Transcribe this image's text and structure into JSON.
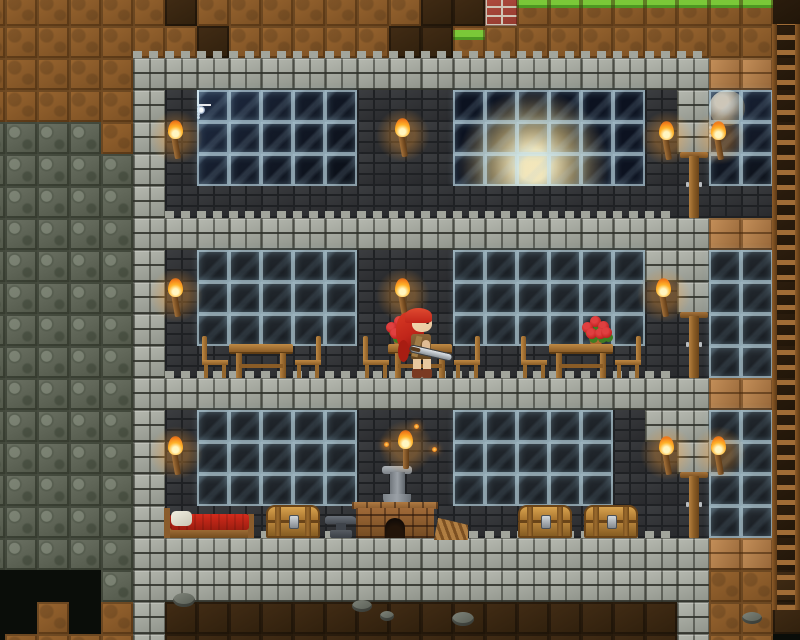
{
  "scene": {
    "name": "sandbox-building-scene",
    "description": "side-view 2d sandbox game: three-storey stone-brick house in a dirt hillside, night sky and earth visible through upper windows, dining room with red-haired character holding a sword, basement with bed, chests, anvil and furnace, ladder shaft on the right",
    "tile_size": 32,
    "origin": {
      "x": -27,
      "y": -6
    },
    "cols": 26,
    "rows": 21,
    "legend": {
      "D": "dirt-block",
      "G": "grass-block",
      "d": "dirt-wall-background",
      "K": "cave-darkness",
      "R": "red-brick-block",
      "s": "raw-stone-block",
      "S": "stone-brick-block",
      "B": "brick-wall-background",
      "W": "glass-window-block",
      "N": "glass-window-night-block",
      "E": "glass-window-earth-block",
      "P": "wood-plank-block",
      "L": "ladder-shaft-background"
    },
    "tilemap": [
      "DDDDDDdDDDDDDDddRGGGGGGGGL",
      "DDDDDDDdDDDDDddGDDDDDDDDDL",
      "DDDDDSSSSSSSSSSSSSSSSSSPPL",
      "DDDDDSBNNNNNBBBEEEEEEBSNNL",
      "ssssDSBNNNNNBBBEEEEEEBSNNL",
      "sssssSBNNNNNBBBEEEEEEBBNNL",
      "sssssSBBBBBBBBBBBBBBBBBBBL",
      "sssssSSSSSSSSSSSSSSSSSSPPL",
      "sssssSBWWWWWBBBWWWWWWSSWWL",
      "sssssSBWWWWWBBBWWWWWWBSWWL",
      "sssssSBWWWWWBBBWWWWWWBBWWL",
      "sssssSBBBBBBBBBBBBBBBBBWWL",
      "sssssSSSSSSSSSSSSSSSSSSPPL",
      "sssssSBWWWWWBBBWWWWWBSSWWL",
      "sssssSBWWWWWBBBWWWWWBBSWWL",
      "sssssSBWWWWWBBBWWWWWBBBWWL",
      "sssssSBBBBBBBBBBBBBBBBBWWL",
      "sssssSSSSSSSSSSSSSSSSSSPPL",
      "KKKKsSSSSSSSSSSSSSSSSSSDDd",
      "KKDKDSddddddddddddddddSDDd",
      "KDDDDSddddddddddddddddSDDK"
    ],
    "palette": {
      "stone": "#8f938a",
      "mortar": "#1f2124",
      "dirt": "#9a6630",
      "grass": "#74c534",
      "rawstone": "#6c7264",
      "glass": "#14181d",
      "glass_frame": "#cfe9f2",
      "wood": "#b5823e",
      "wood_dark": "#6a4418",
      "flame": "#ffb32a",
      "redbrick": "#b24e40",
      "blanket": "#d42b1c",
      "rose": "#c42222",
      "earth": "#4a80b8",
      "space": "#0c1220",
      "skin": "#e8c8a0",
      "hair": "#c0251a"
    },
    "backdrops": [
      {
        "t": "space-night",
        "x": 197,
        "y": 90,
        "w": 160,
        "h": 96,
        "children": [
          {
            "t": "star-big",
            "x": 24,
            "y": 12
          },
          {
            "t": "star-dot",
            "x": 12,
            "y": 4
          },
          {
            "t": "star-dot",
            "x": 58,
            "y": 24
          },
          {
            "t": "star-dot",
            "x": 104,
            "y": 18
          },
          {
            "t": "star-dot",
            "x": 132,
            "y": 62
          },
          {
            "t": "star-dot",
            "x": 84,
            "y": 46
          }
        ]
      },
      {
        "t": "space-earth",
        "x": 453,
        "y": 90,
        "w": 192,
        "h": 96,
        "children": []
      },
      {
        "t": "space-moon",
        "x": 709,
        "y": 90,
        "w": 64,
        "h": 96,
        "children": [
          {
            "t": "moon",
            "x": 3,
            "y": 62
          },
          {
            "t": "star-dot",
            "x": 12,
            "y": 8
          },
          {
            "t": "spark",
            "x": 22,
            "y": 12
          },
          {
            "t": "star-dot",
            "x": 44,
            "y": 36
          }
        ]
      }
    ],
    "entities": [
      {
        "t": "ledge",
        "x": 133,
        "y": 51,
        "w": 576
      },
      {
        "t": "ledge",
        "x": 165,
        "y": 211,
        "w": 512
      },
      {
        "t": "ledge",
        "x": 165,
        "y": 371,
        "w": 512
      },
      {
        "t": "ledge",
        "x": 165,
        "y": 531,
        "w": 512
      },
      {
        "t": "rose-pot",
        "x": 385,
        "y": 314
      },
      {
        "t": "rose-pot",
        "x": 581,
        "y": 314
      },
      {
        "t": "table",
        "x": 229,
        "y": 344
      },
      {
        "t": "table",
        "x": 388,
        "y": 344
      },
      {
        "t": "table",
        "x": 549,
        "y": 344
      },
      {
        "t": "chair",
        "x": 202,
        "y": 336,
        "dir": "right"
      },
      {
        "t": "chair",
        "x": 295,
        "y": 336,
        "dir": "left"
      },
      {
        "t": "chair",
        "x": 363,
        "y": 336,
        "dir": "right"
      },
      {
        "t": "chair",
        "x": 454,
        "y": 336,
        "dir": "left"
      },
      {
        "t": "chair",
        "x": 521,
        "y": 336,
        "dir": "right"
      },
      {
        "t": "chair",
        "x": 615,
        "y": 336,
        "dir": "left"
      },
      {
        "t": "bed",
        "x": 164,
        "y": 506
      },
      {
        "t": "chest",
        "x": 266,
        "y": 505
      },
      {
        "t": "chest",
        "x": 518,
        "y": 505
      },
      {
        "t": "chest",
        "x": 584,
        "y": 505
      },
      {
        "t": "anvil",
        "x": 325,
        "y": 516
      },
      {
        "t": "furnace",
        "x": 352,
        "y": 466
      },
      {
        "t": "bellows",
        "x": 434,
        "y": 514
      },
      {
        "t": "door",
        "x": 680,
        "y": 152
      },
      {
        "t": "door",
        "x": 680,
        "y": 312
      },
      {
        "t": "door",
        "x": 680,
        "y": 472
      },
      {
        "t": "torch",
        "x": 164,
        "y": 122
      },
      {
        "t": "torch",
        "x": 391,
        "y": 120
      },
      {
        "t": "torch",
        "x": 655,
        "y": 123
      },
      {
        "t": "torch",
        "x": 707,
        "y": 123
      },
      {
        "t": "torch",
        "x": 164,
        "y": 280
      },
      {
        "t": "torch",
        "x": 391,
        "y": 280
      },
      {
        "t": "torch",
        "x": 652,
        "y": 280
      },
      {
        "t": "torch",
        "x": 164,
        "y": 438
      },
      {
        "t": "torch",
        "x": 655,
        "y": 438
      },
      {
        "t": "torch",
        "x": 707,
        "y": 438
      },
      {
        "t": "torch",
        "x": 394,
        "y": 432,
        "standing": true
      },
      {
        "t": "ladder",
        "x": 772,
        "y": 24,
        "w": 28,
        "h": 586
      },
      {
        "t": "character",
        "x": 396,
        "y": 308
      },
      {
        "t": "rock",
        "x": 173,
        "y": 593,
        "w": 22,
        "h": 14
      },
      {
        "t": "rock",
        "x": 352,
        "y": 600,
        "w": 20,
        "h": 12
      },
      {
        "t": "rock",
        "x": 380,
        "y": 611,
        "w": 14,
        "h": 10
      },
      {
        "t": "rock",
        "x": 452,
        "y": 612,
        "w": 22,
        "h": 14
      },
      {
        "t": "rock",
        "x": 742,
        "y": 612,
        "w": 20,
        "h": 12
      },
      {
        "t": "spark",
        "x": 384,
        "y": 442
      },
      {
        "t": "spark",
        "x": 432,
        "y": 447
      },
      {
        "t": "spark",
        "x": 414,
        "y": 424
      }
    ]
  }
}
